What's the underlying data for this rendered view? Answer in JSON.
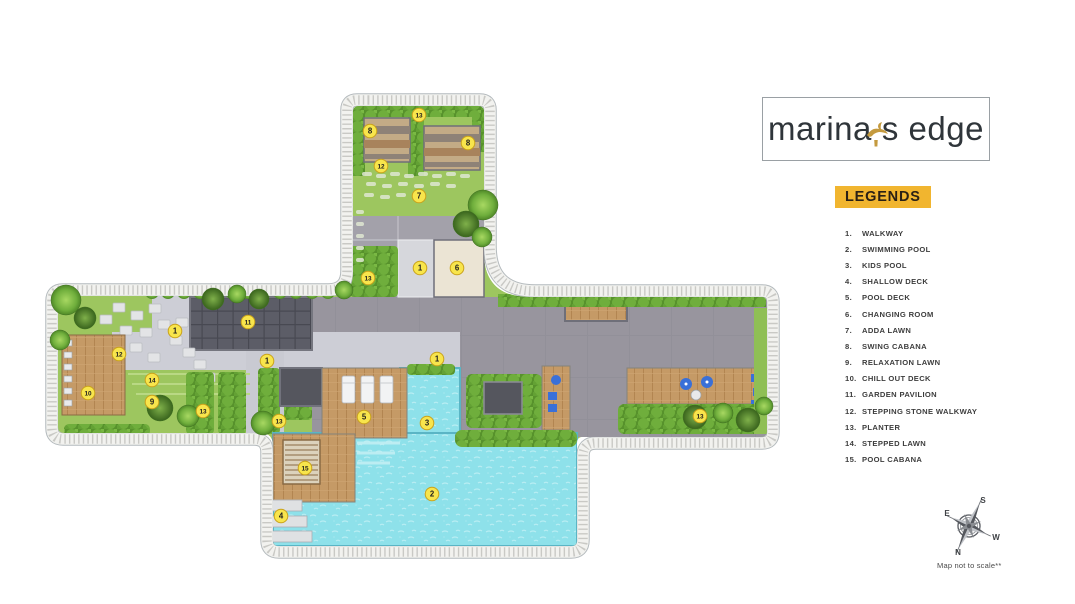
{
  "logo": {
    "part1": "marina",
    "apostrophe": "'",
    "part2": "s edge"
  },
  "legend": {
    "title": "LEGENDS",
    "items": [
      {
        "num": "1.",
        "label": "WALKWAY"
      },
      {
        "num": "2.",
        "label": "SWIMMING POOL"
      },
      {
        "num": "3.",
        "label": "KIDS POOL"
      },
      {
        "num": "4.",
        "label": "SHALLOW DECK"
      },
      {
        "num": "5.",
        "label": "POOL DECK"
      },
      {
        "num": "6.",
        "label": "CHANGING ROOM"
      },
      {
        "num": "7.",
        "label": "ADDA LAWN"
      },
      {
        "num": "8.",
        "label": "SWING CABANA"
      },
      {
        "num": "9.",
        "label": "RELAXATION LAWN"
      },
      {
        "num": "10.",
        "label": "CHILL OUT DECK"
      },
      {
        "num": "11.",
        "label": "GARDEN PAVILION"
      },
      {
        "num": "12.",
        "label": "STEPPING STONE WALKWAY"
      },
      {
        "num": "13.",
        "label": "PLANTER"
      },
      {
        "num": "14.",
        "label": "STEPPED LAWN"
      },
      {
        "num": "15.",
        "label": "POOL CABANA"
      }
    ]
  },
  "compass": {
    "n": "N",
    "s": "S",
    "e": "E",
    "w": "W",
    "note": "Map not to scale**"
  },
  "plan": {
    "markers": [
      {
        "n": "13",
        "x": 419,
        "y": 115
      },
      {
        "n": "8",
        "x": 370,
        "y": 131
      },
      {
        "n": "8",
        "x": 468,
        "y": 143
      },
      {
        "n": "12",
        "x": 381,
        "y": 166
      },
      {
        "n": "7",
        "x": 419,
        "y": 196
      },
      {
        "n": "1",
        "x": 420,
        "y": 268
      },
      {
        "n": "6",
        "x": 457,
        "y": 268
      },
      {
        "n": "13",
        "x": 368,
        "y": 278
      },
      {
        "n": "11",
        "x": 248,
        "y": 322
      },
      {
        "n": "1",
        "x": 175,
        "y": 331
      },
      {
        "n": "12",
        "x": 119,
        "y": 354
      },
      {
        "n": "1",
        "x": 267,
        "y": 361
      },
      {
        "n": "1",
        "x": 437,
        "y": 359
      },
      {
        "n": "14",
        "x": 152,
        "y": 380
      },
      {
        "n": "9",
        "x": 152,
        "y": 402
      },
      {
        "n": "10",
        "x": 88,
        "y": 393
      },
      {
        "n": "13",
        "x": 203,
        "y": 411
      },
      {
        "n": "13",
        "x": 279,
        "y": 421
      },
      {
        "n": "13",
        "x": 700,
        "y": 416
      },
      {
        "n": "5",
        "x": 364,
        "y": 417
      },
      {
        "n": "3",
        "x": 427,
        "y": 423
      },
      {
        "n": "15",
        "x": 305,
        "y": 468
      },
      {
        "n": "2",
        "x": 432,
        "y": 494
      },
      {
        "n": "4",
        "x": 281,
        "y": 516
      }
    ]
  },
  "colors": {
    "lawn": "#9dc65f",
    "hedge": "#5f9d31",
    "pool_water": "#8ee1ea",
    "deck_gray": "#98959e",
    "walkway_gray": "#cdced6",
    "wood": "#c59a66",
    "pavilion_gray": "#5c5d67",
    "marker_yellow": "#f8e54c",
    "legend_gold": "#f1b52f",
    "logo_gold": "#c49a3f"
  }
}
